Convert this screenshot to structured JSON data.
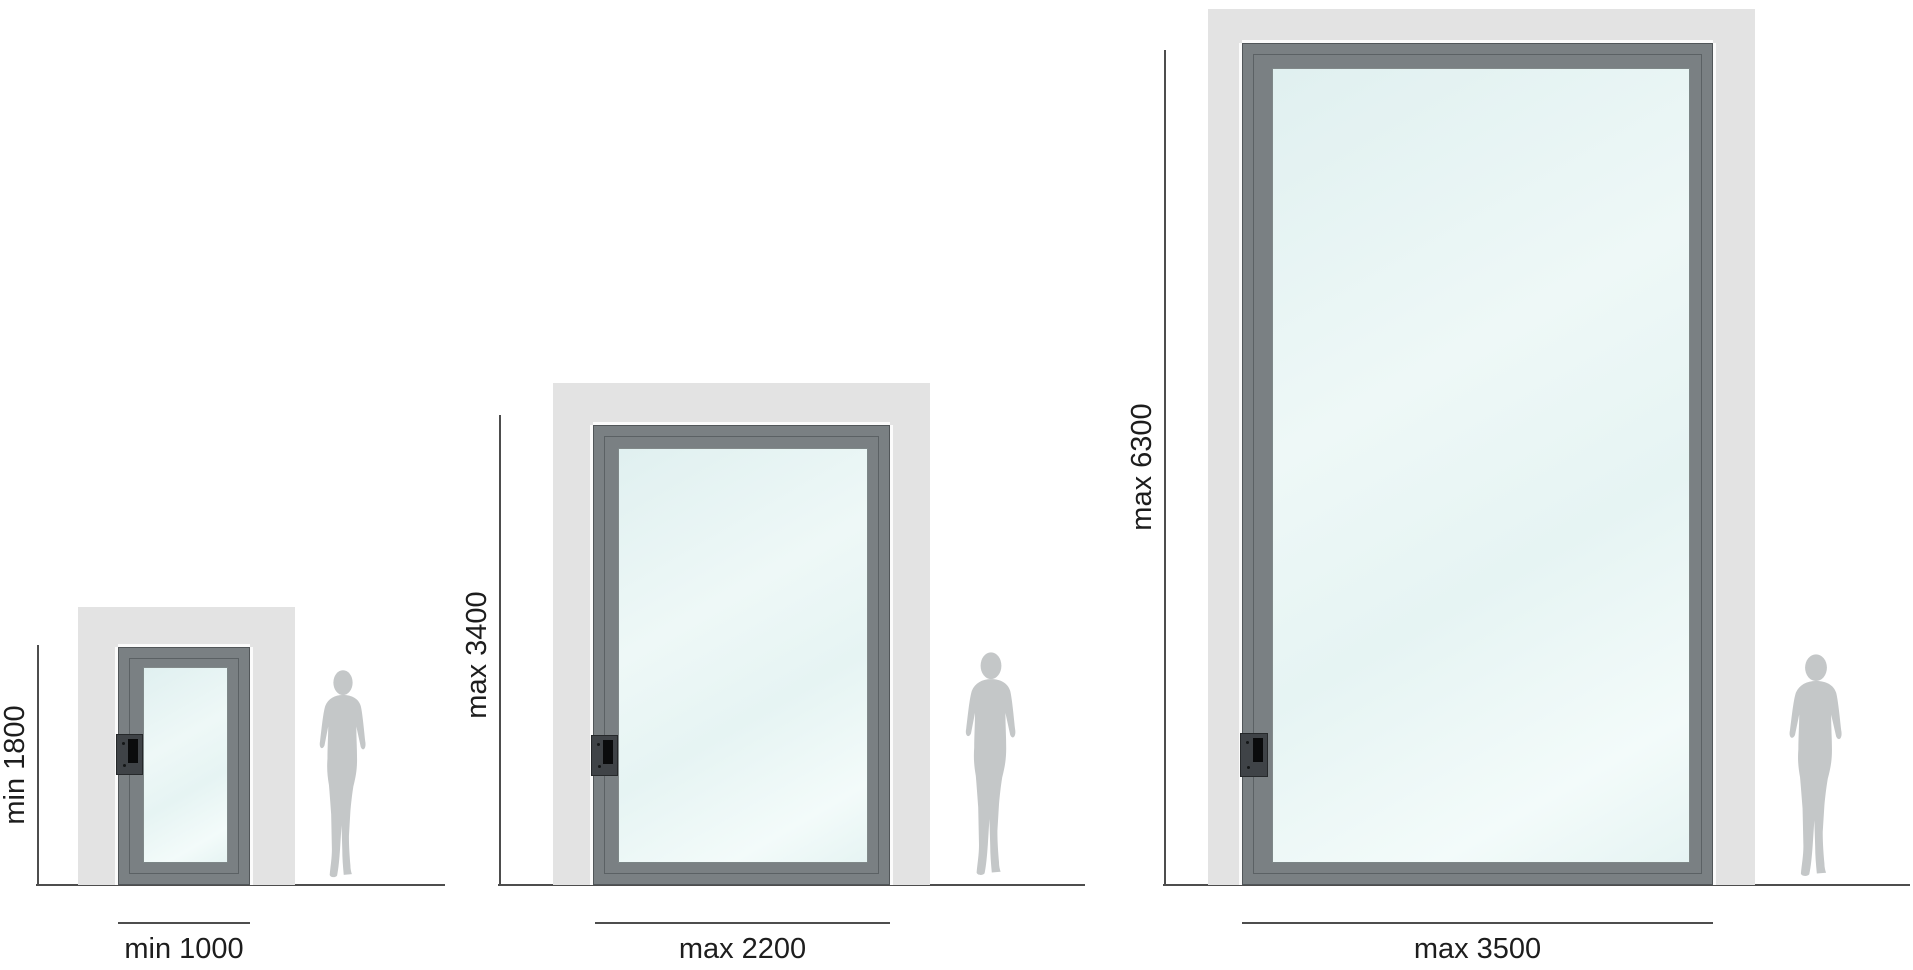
{
  "figures": [
    {
      "name": "minimum-size-door",
      "height_label": "min 1800",
      "width_label": "min 1000"
    },
    {
      "name": "medium-size-door",
      "height_label": "max 3400",
      "width_label": "max 2200"
    },
    {
      "name": "maximum-size-door",
      "height_label": "max 6300",
      "width_label": "max 3500"
    }
  ],
  "colors": {
    "wall": "#e3e3e3",
    "frame": "#7a8083",
    "glass_a": "#e0f0f0",
    "glass_b": "#eef8f7",
    "glass_c": "#e6f4f3",
    "silhouette": "#c4c7c8",
    "dim_line": "#4d4d4d",
    "text": "#1d1d1d",
    "lock_body": "#3f4347",
    "lock_slot": "#0a0b0c"
  }
}
